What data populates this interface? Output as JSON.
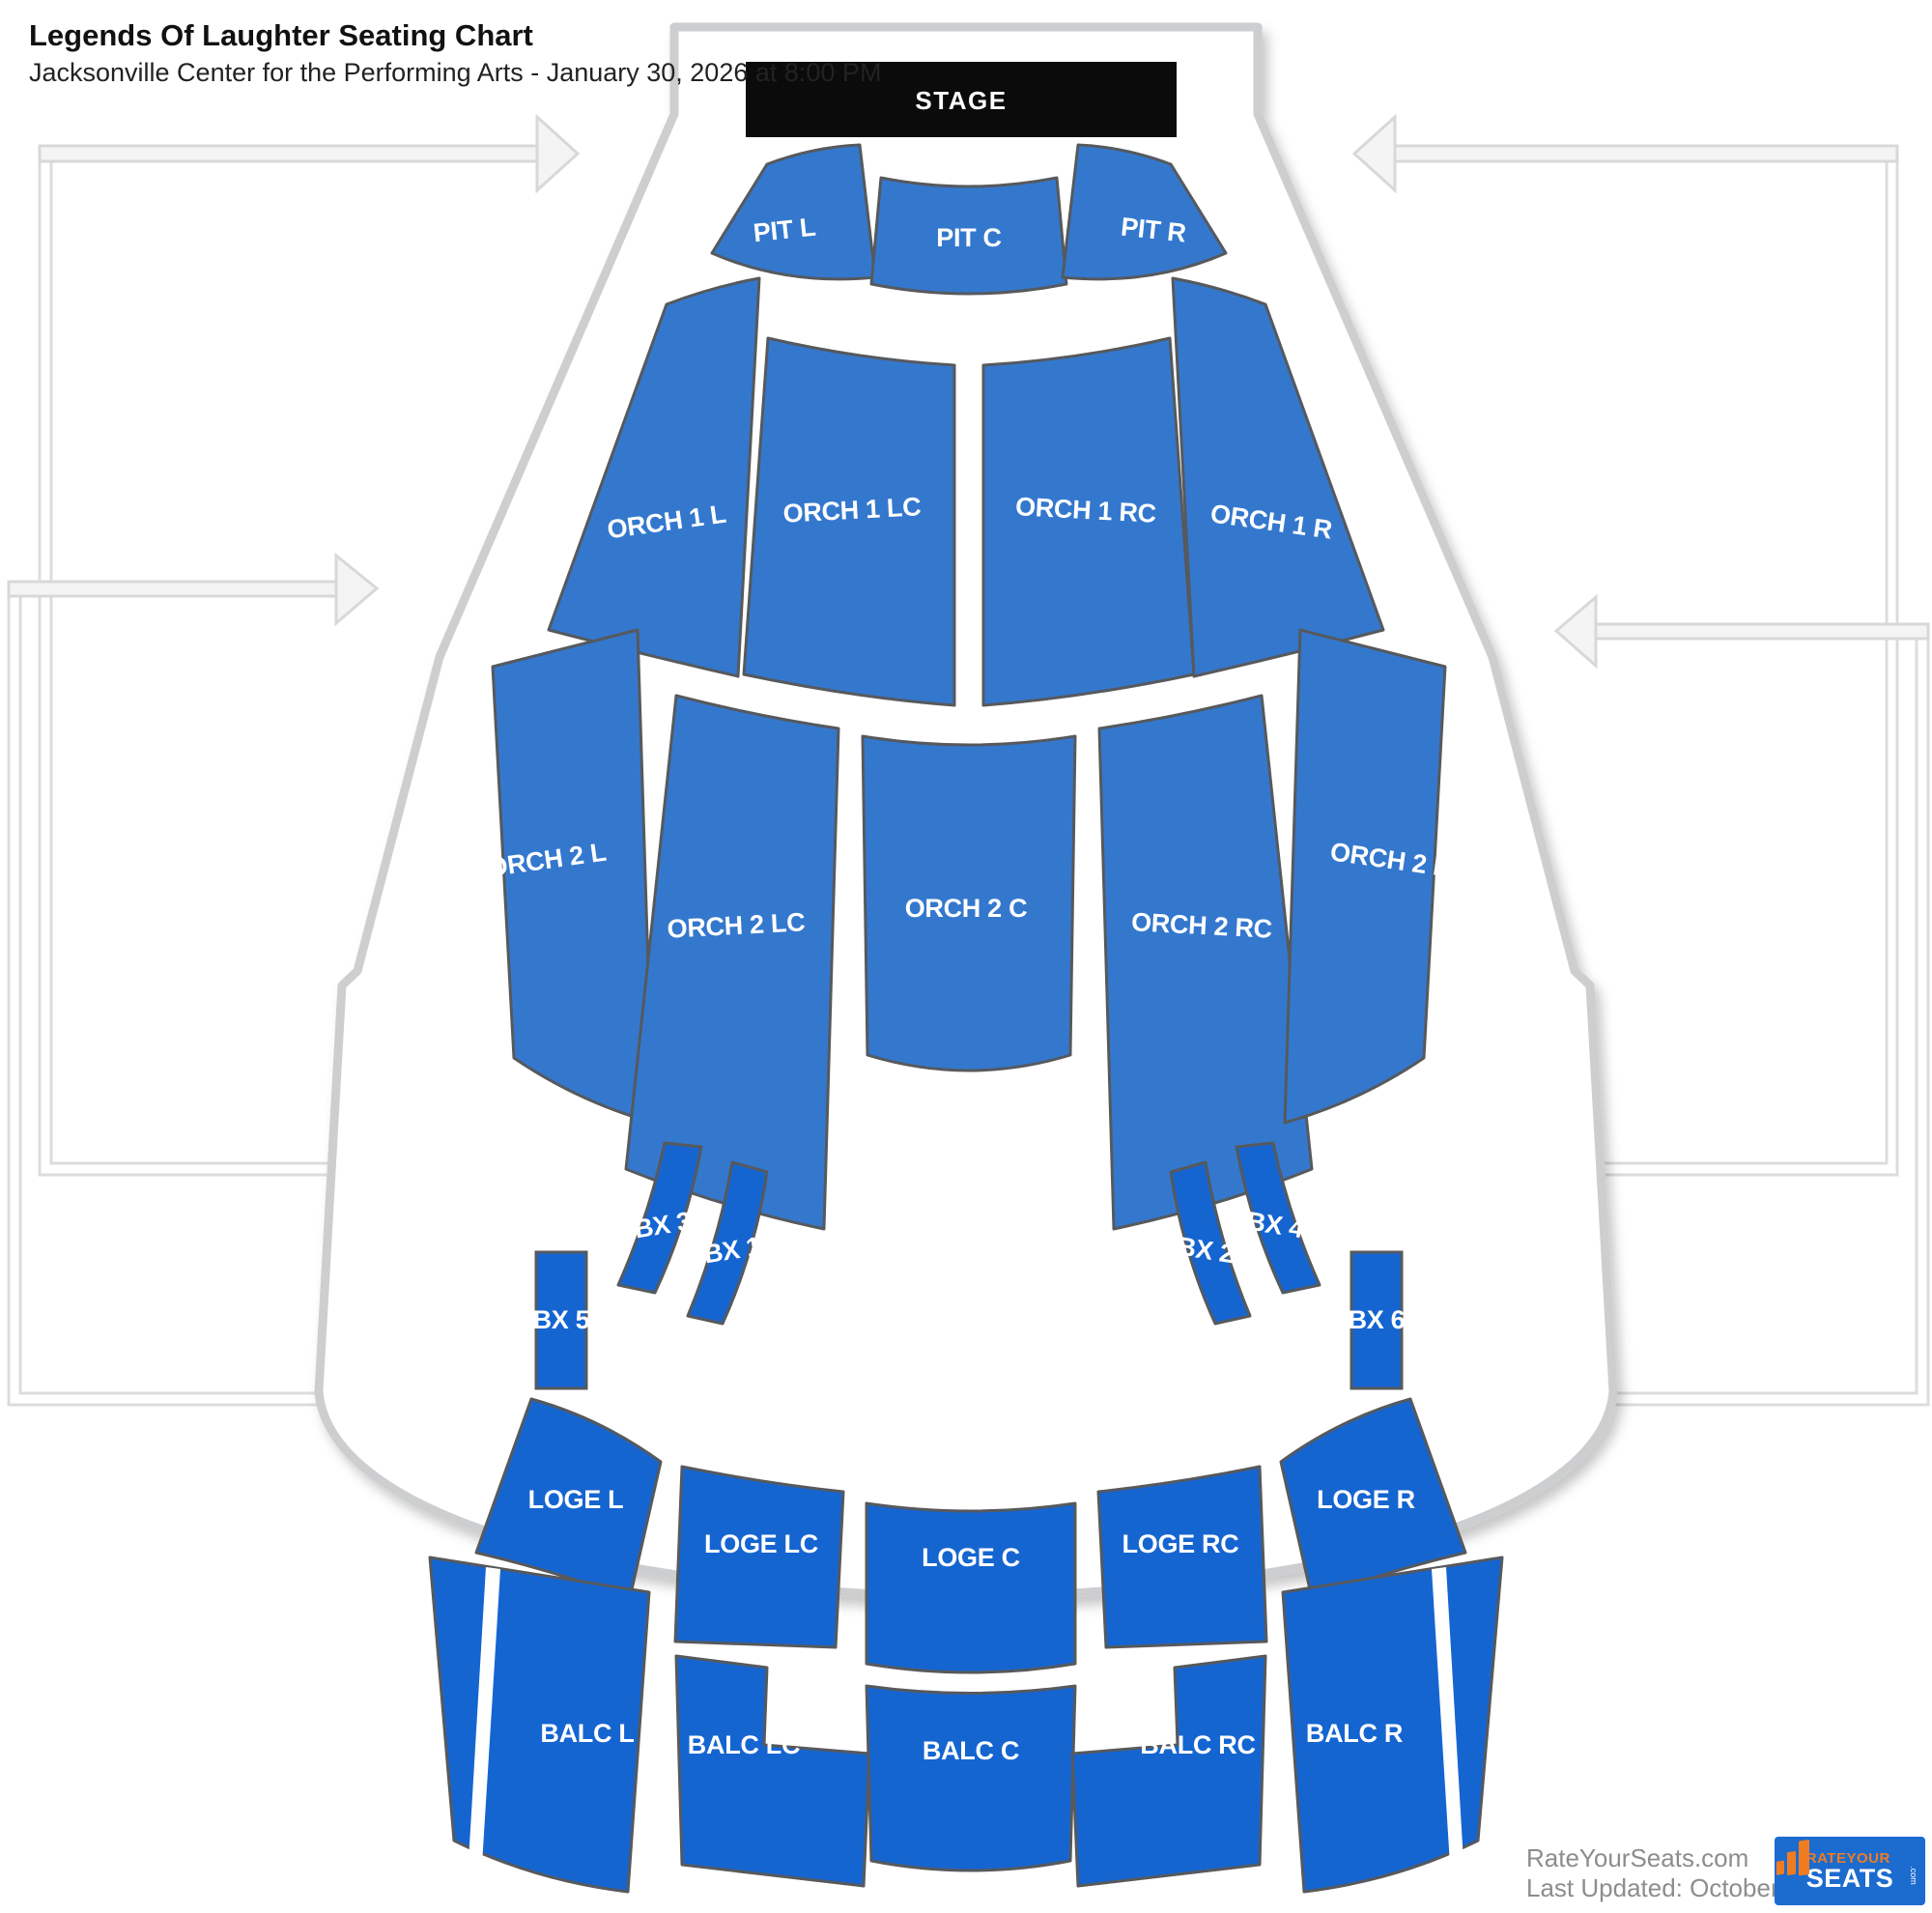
{
  "header": {
    "title": "Legends Of Laughter Seating Chart",
    "subtitle": "Jacksonville Center for the Performing Arts - January 30, 2026 at 8:00 PM"
  },
  "stage": {
    "label": "STAGE"
  },
  "colors": {
    "section_blue": "#3478ce",
    "section_blue_dark": "#1565d1",
    "section_border": "#56595d",
    "stage_bg": "#0b0b0b",
    "outline_gray": "#cdced0",
    "arrow_fill": "#f4f4f4",
    "arrow_border": "#d8d8d8",
    "logo_blue": "#1c6bcf",
    "logo_orange": "#f07c22"
  },
  "sections": [
    {
      "name": "pit-l",
      "label": "PIT L"
    },
    {
      "name": "pit-c",
      "label": "PIT C"
    },
    {
      "name": "pit-r",
      "label": "PIT R"
    },
    {
      "name": "orch-1-l",
      "label": "ORCH 1 L"
    },
    {
      "name": "orch-1-lc",
      "label": "ORCH 1 LC"
    },
    {
      "name": "orch-1-rc",
      "label": "ORCH 1 RC"
    },
    {
      "name": "orch-1-r",
      "label": "ORCH 1 R"
    },
    {
      "name": "orch-2-l",
      "label": "ORCH 2 L"
    },
    {
      "name": "orch-2-lc",
      "label": "ORCH 2 LC"
    },
    {
      "name": "orch-2-c",
      "label": "ORCH 2 C"
    },
    {
      "name": "orch-2-rc",
      "label": "ORCH 2 RC"
    },
    {
      "name": "orch-2-r",
      "label": "ORCH 2 R"
    },
    {
      "name": "bx-3",
      "label": "BX 3"
    },
    {
      "name": "bx-1",
      "label": "BX 1"
    },
    {
      "name": "bx-2",
      "label": "BX 2"
    },
    {
      "name": "bx-4",
      "label": "BX 4"
    },
    {
      "name": "bx-5",
      "label": "BX 5"
    },
    {
      "name": "bx-6",
      "label": "BX 6"
    },
    {
      "name": "loge-l",
      "label": "LOGE L"
    },
    {
      "name": "loge-lc",
      "label": "LOGE LC"
    },
    {
      "name": "loge-c",
      "label": "LOGE C"
    },
    {
      "name": "loge-rc",
      "label": "LOGE RC"
    },
    {
      "name": "loge-r",
      "label": "LOGE R"
    },
    {
      "name": "balc-l",
      "label": "BALC L"
    },
    {
      "name": "balc-lc",
      "label": "BALC LC"
    },
    {
      "name": "balc-c",
      "label": "BALC C"
    },
    {
      "name": "balc-rc",
      "label": "BALC RC"
    },
    {
      "name": "balc-r",
      "label": "BALC R"
    }
  ],
  "footer": {
    "site": "RateYourSeats.com",
    "updated": "Last Updated: October 27, 2025",
    "logo_line1": "RATEYOUR",
    "logo_line2": "SEATS",
    "logo_suffix": ".com"
  }
}
